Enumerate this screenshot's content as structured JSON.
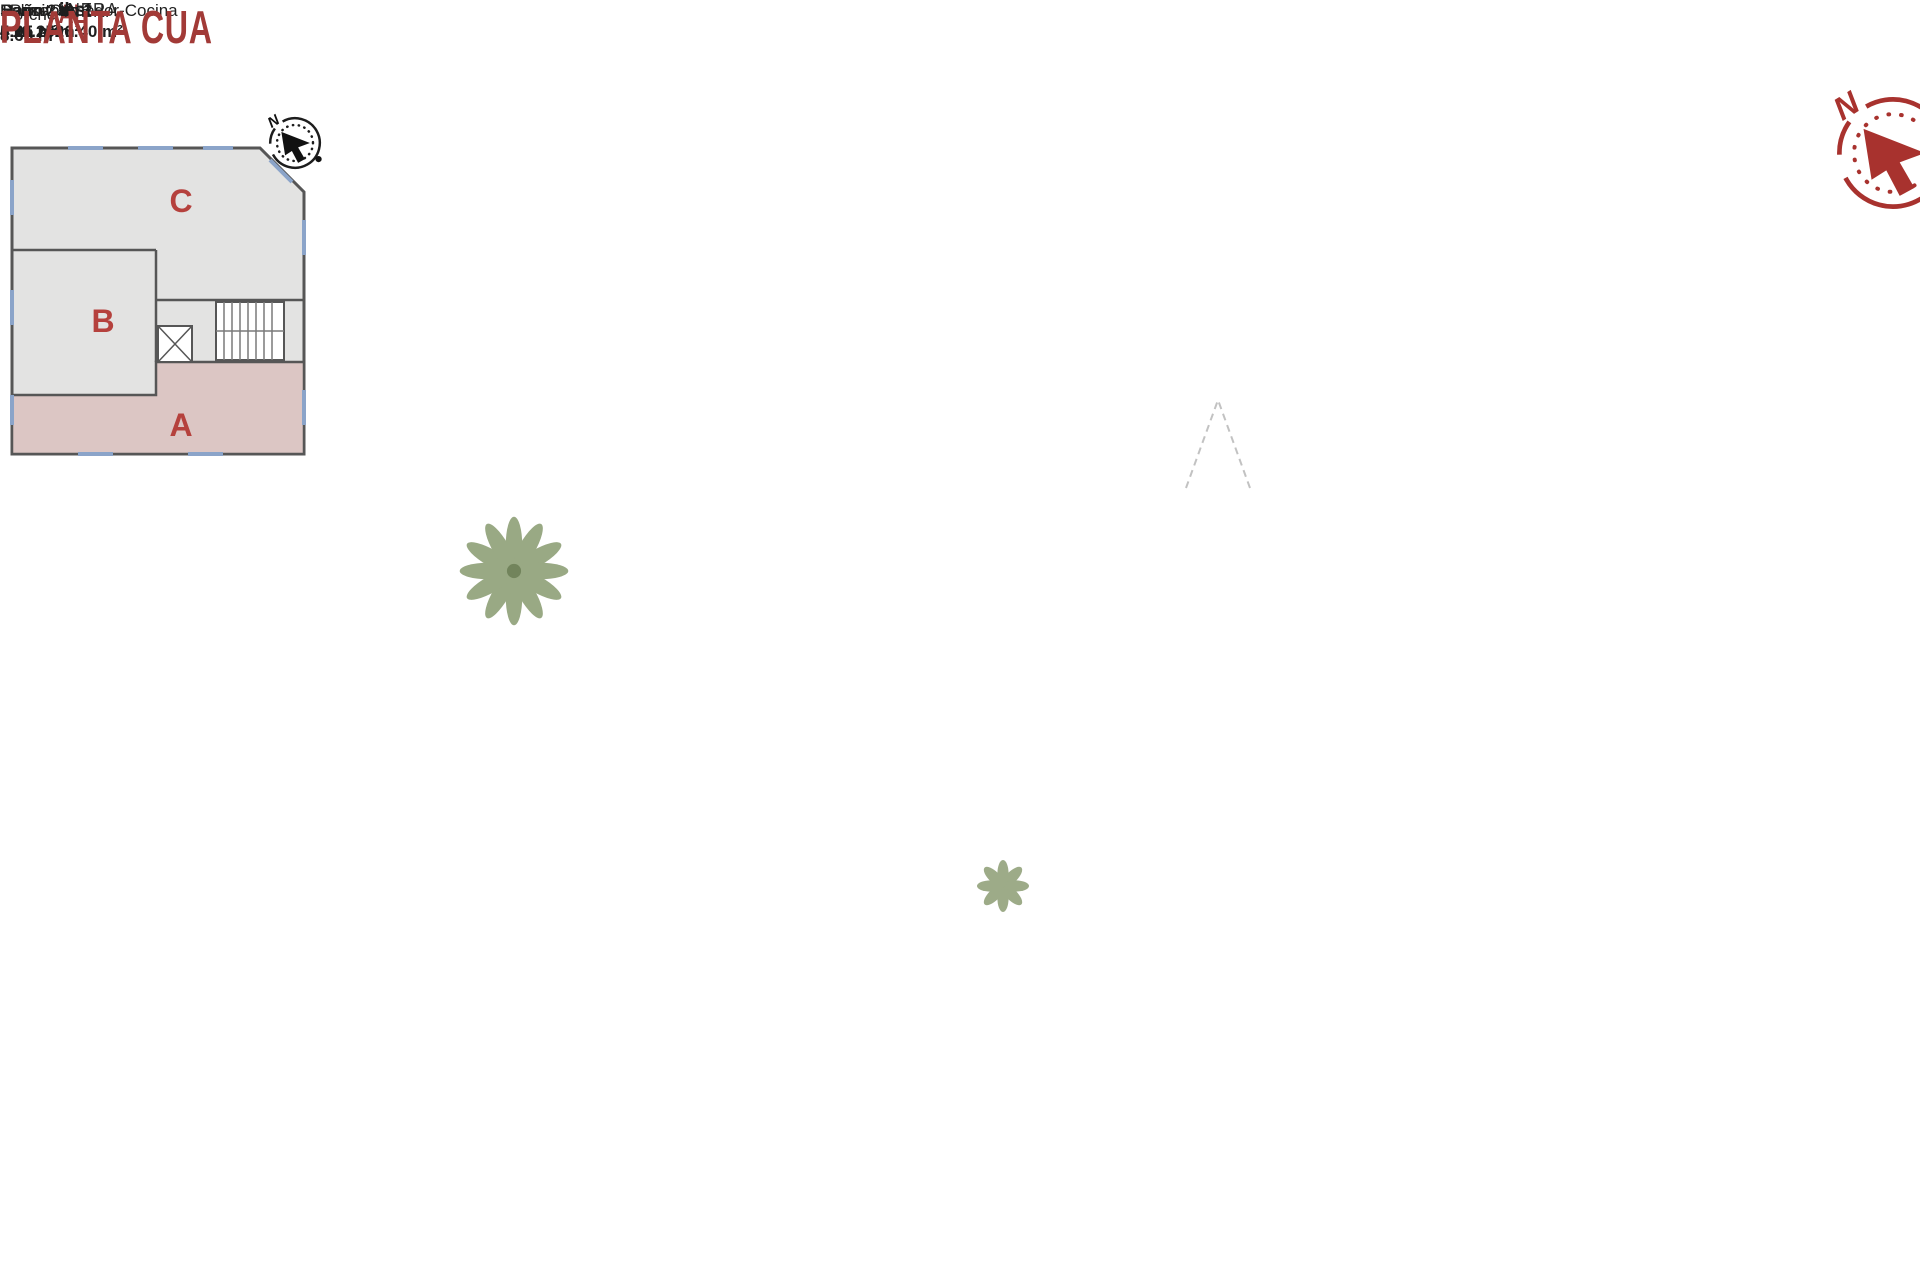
{
  "panel": {
    "sections": {
      "general": "ENERAL",
      "perspective": "VA",
      "surfaces": "S"
    },
    "site_plan": {
      "unit_a": "A",
      "unit_b": "B",
      "unit_c": "C",
      "boundary_label": "MEDIANERA",
      "compass_n": "N"
    },
    "table": {
      "headers": [
        "Uso",
        "Sup.útil",
        "Sup.const."
      ],
      "rows": [
        {
          "uso": "vivienda",
          "sup_util": "62.20 m²",
          "sup_const": "73.29 m²"
        },
        {
          "uso": "porche",
          "sup_util": "8.65 m²",
          "sup_const": "8.65 m²"
        }
      ],
      "total_util": "70.85 m²",
      "total_const": "81.94 m²"
    }
  },
  "floorplan": {
    "compass_n": "N",
    "caption": "PLANTA CUA",
    "rooms": {
      "porche": {
        "name": "Porche",
        "area": "8.65 m²"
      },
      "salon": {
        "name": "Salón-Comedor-Cocina",
        "area": "26.40 m²"
      },
      "bano2": {
        "name": "Baño 2",
        "area": "4.25 m²"
      },
      "paso": {
        "name": "Paso",
        "area": "5.05 m²"
      },
      "dormitorio2": {
        "name": "Dormitorio 2",
        "area": "10.15 m²"
      },
      "bano1": {
        "name": "Baño 1",
        "area": "4.15 m²"
      },
      "dormitorio1": {
        "name": "Dormitorio 1",
        "area": "12.20 m²"
      }
    }
  },
  "colors": {
    "accent_red": "#9e3a38",
    "wall": "#4d4d4d",
    "floor": "#e8e3da",
    "unit_highlight": "#dcc6c4",
    "unit_gray": "#e3e3e2",
    "window_blue": "#8ba4c9",
    "compass_red": "#a8322e"
  }
}
